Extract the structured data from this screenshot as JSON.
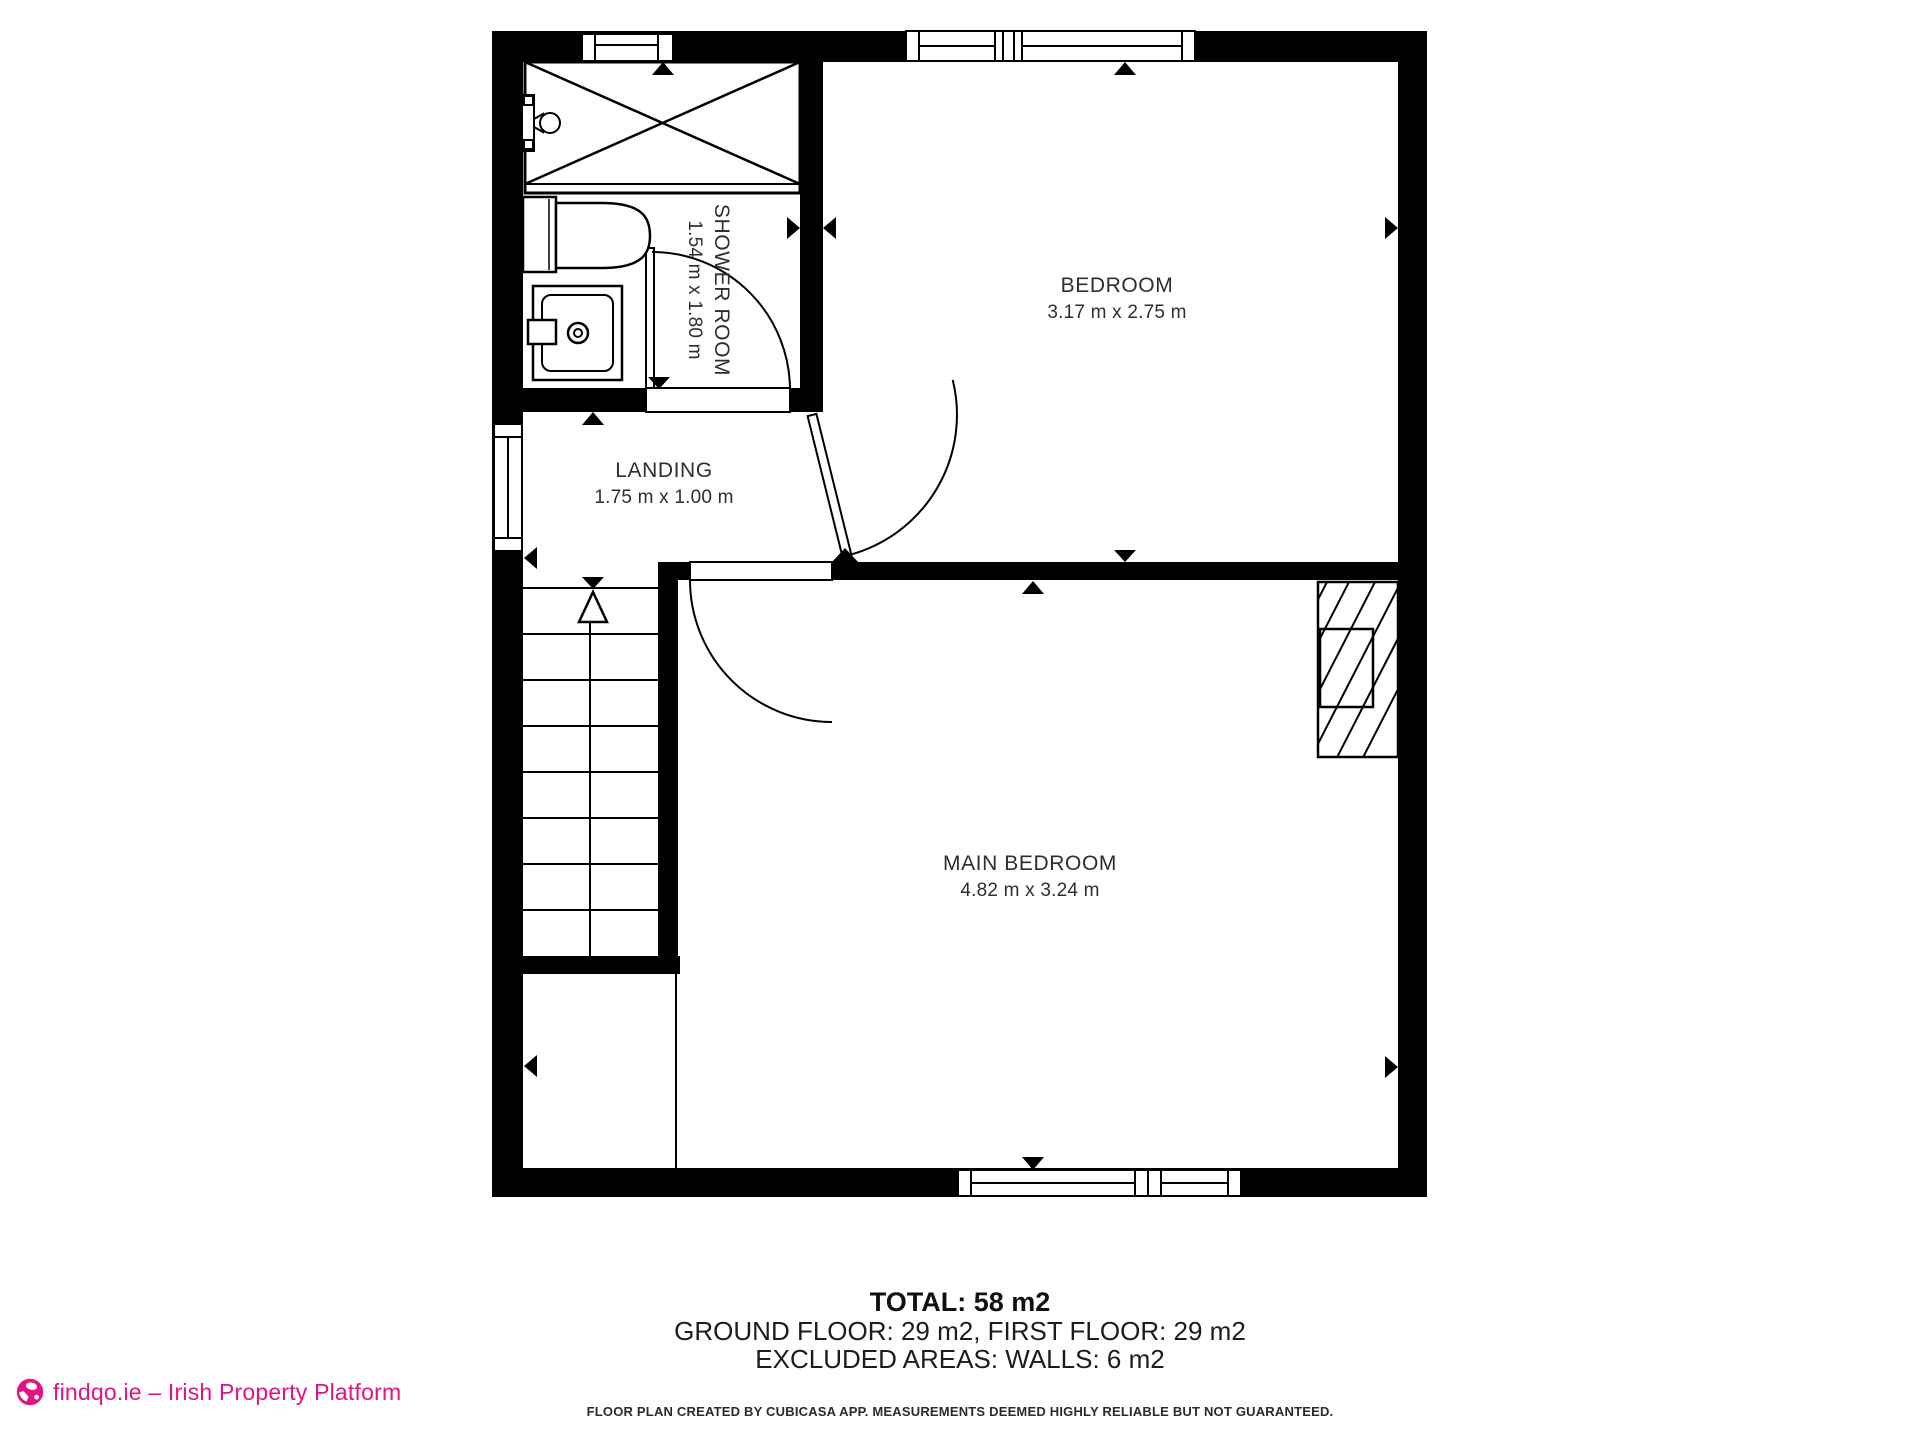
{
  "colors": {
    "wall": "#000000",
    "line": "#000000",
    "accent_pink": "#e11484",
    "text": "#2e2e2e"
  },
  "rooms": [
    {
      "id": "shower_room",
      "name": "SHOWER ROOM",
      "dims": "1.54 m x 1.80 m"
    },
    {
      "id": "bedroom",
      "name": "BEDROOM",
      "dims": "3.17 m x 2.75 m"
    },
    {
      "id": "landing",
      "name": "LANDING",
      "dims": "1.75 m x 1.00 m"
    },
    {
      "id": "main_bedroom",
      "name": "MAIN BEDROOM",
      "dims": "4.82 m x 3.24 m"
    }
  ],
  "summary": {
    "total": "TOTAL: 58 m2",
    "floors": "GROUND FLOOR: 29 m2, FIRST FLOOR: 29 m2",
    "excluded": "EXCLUDED AREAS: WALLS: 6 m2"
  },
  "disclaimer": "FLOOR PLAN CREATED BY CUBICASA APP. MEASUREMENTS DEEMED HIGHLY RELIABLE BUT NOT GUARANTEED.",
  "footer": {
    "brand": "findqo.ie – Irish Property Platform"
  }
}
